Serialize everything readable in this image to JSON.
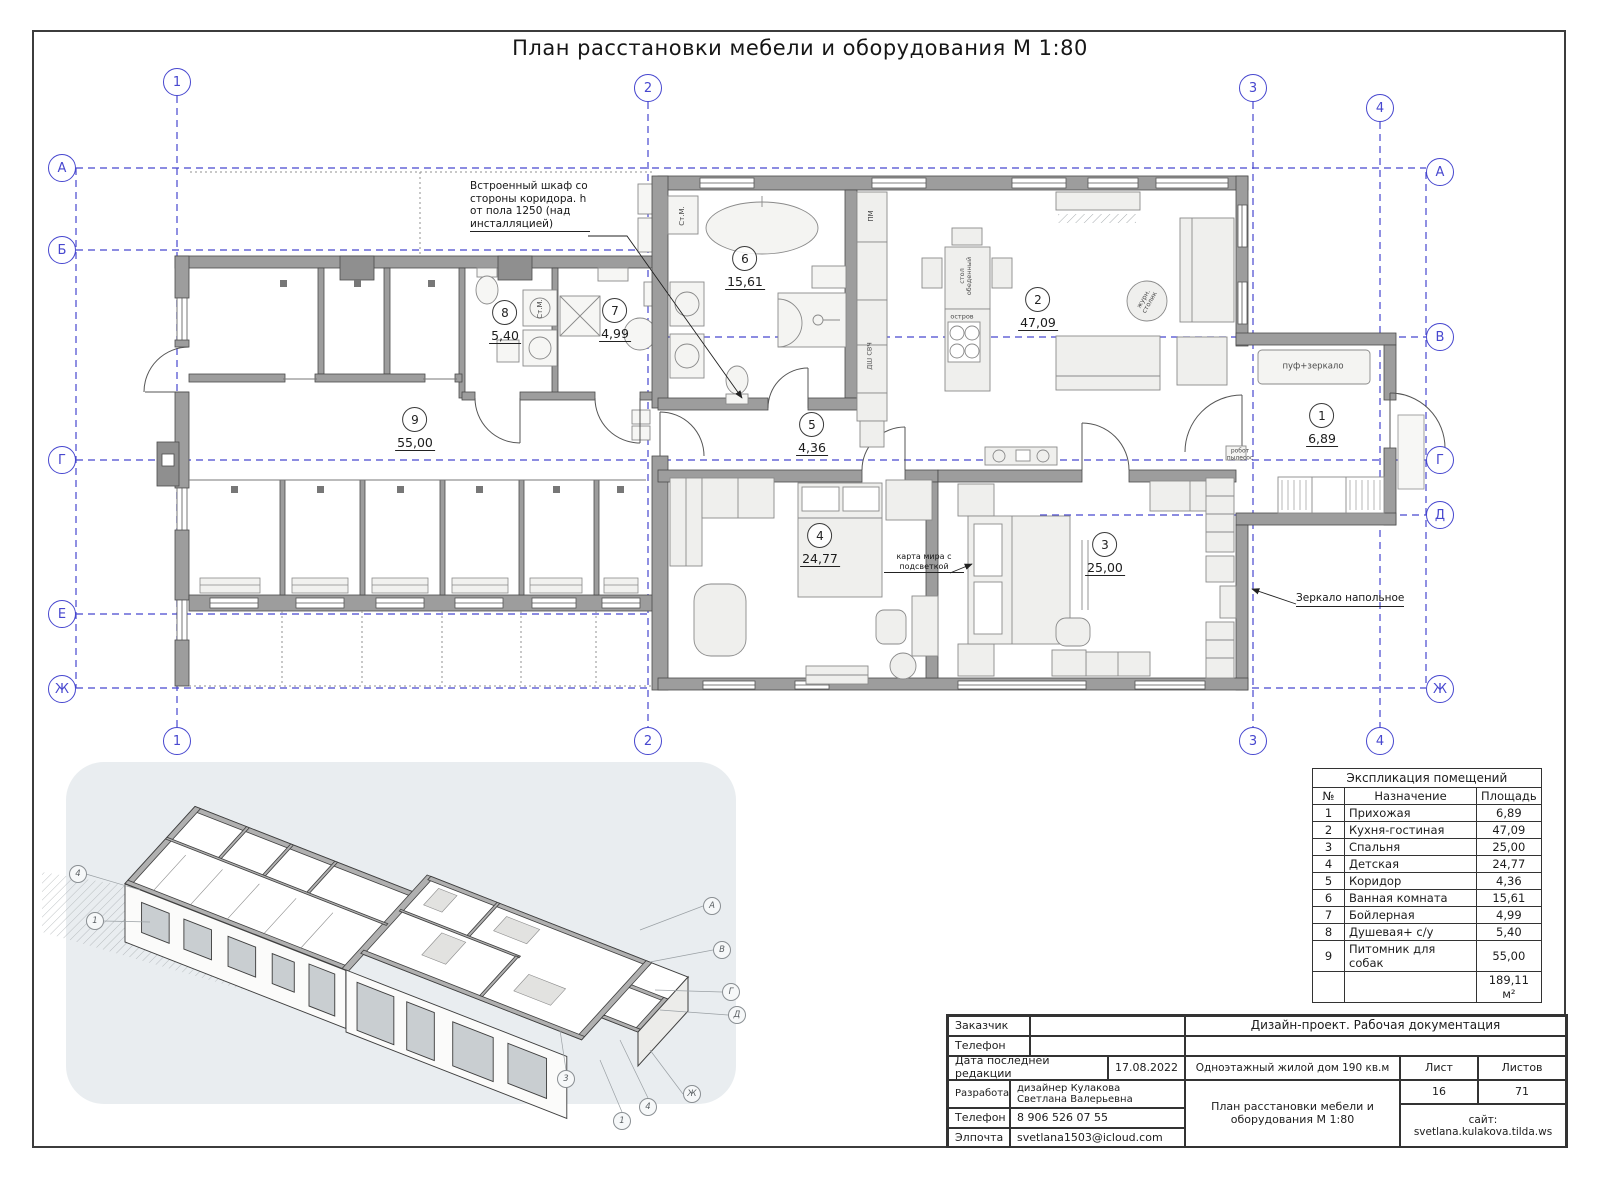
{
  "page": {
    "title": "План расстановки мебели и оборудования М 1:80"
  },
  "grid": {
    "top": [
      "1",
      "2",
      "3",
      "4"
    ],
    "bottom": [
      "1",
      "2",
      "3",
      "4"
    ],
    "left": [
      "А",
      "Б",
      "Г",
      "Е",
      "Ж"
    ],
    "right": [
      "А",
      "В",
      "Г",
      "Д",
      "Ж"
    ]
  },
  "rooms": [
    {
      "num": "1",
      "area": "6,89"
    },
    {
      "num": "2",
      "area": "47,09"
    },
    {
      "num": "3",
      "area": "25,00"
    },
    {
      "num": "4",
      "area": "24,77"
    },
    {
      "num": "5",
      "area": "4,36"
    },
    {
      "num": "6",
      "area": "15,61"
    },
    {
      "num": "7",
      "area": "4,99"
    },
    {
      "num": "8",
      "area": "5,40"
    },
    {
      "num": "9",
      "area": "55,00"
    }
  ],
  "annotations": {
    "builtin_wardrobe": "Встроенный шкаф со стороны коридора. h от пола 1250 (над инсталляцией)",
    "floor_mirror": "Зеркало напольное",
    "world_map": "карта мира с\nподсветкой"
  },
  "plan_labels": {
    "washing_machine": "Ст.М.",
    "dishwasher": "ПМ",
    "oven_micro": "ДШ СВЧ",
    "dining_table": "стол\nобеденный",
    "island": "остров",
    "coffee_table": "журн.\nстолик",
    "pouf_mirror": "пуф+зеркало",
    "robot_vacuum": "робот\nпылесос"
  },
  "explication": {
    "title": "Экспликация помещений",
    "columns": [
      "№",
      "Назначение",
      "Площадь"
    ],
    "rows": [
      [
        "1",
        "Прихожая",
        "6,89"
      ],
      [
        "2",
        "Кухня-гостиная",
        "47,09"
      ],
      [
        "3",
        "Спальня",
        "25,00"
      ],
      [
        "4",
        "Детская",
        "24,77"
      ],
      [
        "5",
        "Коридор",
        "4,36"
      ],
      [
        "6",
        "Ванная комната",
        "15,61"
      ],
      [
        "7",
        "Бойлерная",
        "4,99"
      ],
      [
        "8",
        "Душевая+ с/у",
        "5,40"
      ],
      [
        "9",
        "Питомник для собак",
        "55,00"
      ]
    ],
    "total": "189,11 м²"
  },
  "titleblock": {
    "customer_label": "Заказчик",
    "customer_value": "",
    "phone1_label": "Телефон",
    "phone1_value": "",
    "date_label": "Дата последней редакции",
    "date_value": "17.08.2022",
    "developer_label": "Разработал:",
    "developer_value": "дизайнер Кулакова\nСветлана Валерьевна",
    "phone2_label": "Телефон",
    "phone2_value": "8 906 526 07 55",
    "email_label": "Элпочта",
    "email_value": "svetlana1503@icloud.com",
    "doc_type": "Дизайн-проект. Рабочая документация",
    "object": "Одноэтажный жилой дом 190 кв.м",
    "sheet_label": "Лист",
    "sheets_label": "Листов",
    "sheet_value": "16",
    "sheets_value": "71",
    "drawing_name": "План расстановки мебели и\nоборудования М 1:80",
    "site": "сайт:\nsvetlana.kulakova.tilda.ws"
  },
  "axon_markers": [
    "1",
    "2",
    "3",
    "4",
    "А",
    "В",
    "Г",
    "Д",
    "Ж"
  ]
}
